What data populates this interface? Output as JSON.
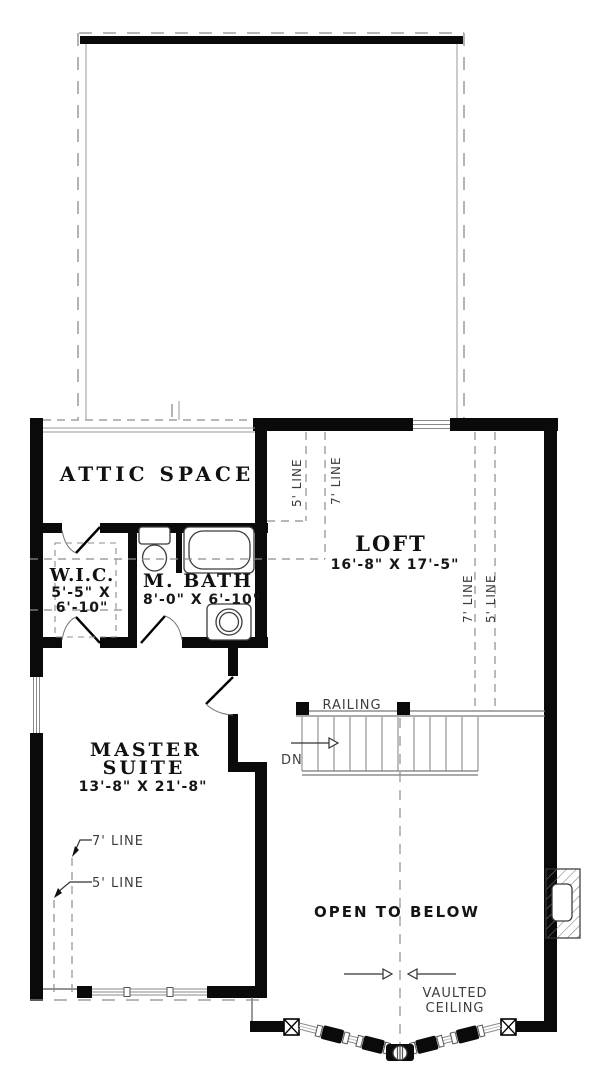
{
  "page": {
    "bg": "#ffffff"
  },
  "plan": {
    "rooms": {
      "attic": {
        "name": "ATTIC SPACE"
      },
      "wic": {
        "name": "W.I.C.",
        "dim_line1": "5'-5\" X",
        "dim_line2": "6'-10\""
      },
      "master_bath": {
        "name": "M. BATH",
        "dim": "8'-0\" X 6'-10\""
      },
      "loft": {
        "name": "LOFT",
        "dim": "16'-8\" X 17'-5\""
      },
      "master_suite": {
        "name_line1": "MASTER",
        "name_line2": "SUITE",
        "dim": "13'-8\" X 21'-8\""
      },
      "open_to_below": {
        "name": "OPEN TO BELOW"
      }
    },
    "annotations": {
      "railing": "RAILING",
      "down": "DN",
      "vaulted_line1": "VAULTED",
      "vaulted_line2": "CEILING",
      "five_line": "5' LINE",
      "seven_line": "7' LINE"
    },
    "colors": {
      "page_bg": "#ffffff",
      "wall": "#0a0a0a",
      "thin_line": "#555555",
      "dash_line": "#8c8c8c",
      "annotation_text": "#3d3d3d",
      "room_text": "#111111"
    }
  }
}
